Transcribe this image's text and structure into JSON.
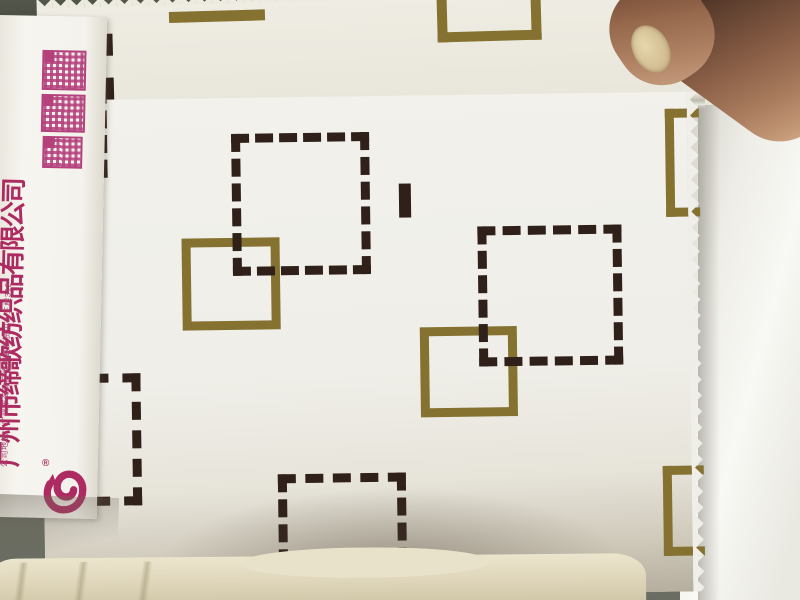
{
  "photo": {
    "type": "fabric swatch catalog photo",
    "company": {
      "name": "广州市缔歌纺织品有限公司",
      "registered_mark": "®",
      "address": "公司地址：广州市海珠区南洲路商贸中心三楼312",
      "brand_color": "#ad2b60"
    },
    "qr_codes": {
      "count": 3,
      "color": "#b4407c"
    },
    "fabric_pattern": {
      "style": "interlocking square outlines print",
      "dashed_square_color": "#2f2019",
      "solid_square_color": "#857130",
      "ground_color": "#f0efe9",
      "edge_finish": "pinked zigzag"
    },
    "other_elements": [
      "hand holding swatch at top right",
      "cream fabric roll at bottom"
    ]
  }
}
